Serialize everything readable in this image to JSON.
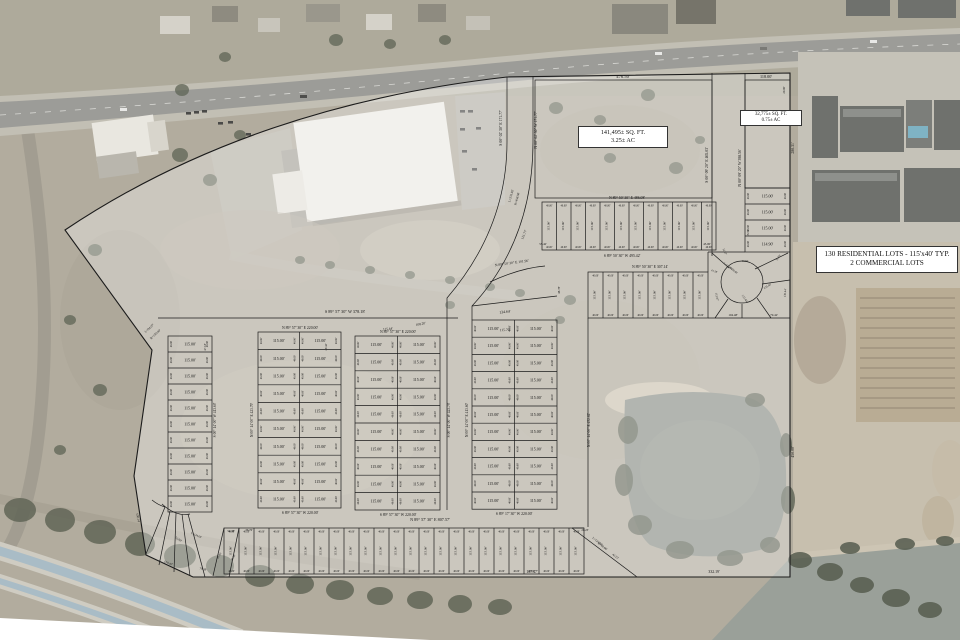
{
  "legend": {
    "line1": "130 RESIDENTIAL LOTS - 115'x40' TYP.",
    "line2": "2 COMMERCIAL LOTS"
  },
  "commercial_lots": [
    {
      "sqft": "141,495± SQ. FT.",
      "acres": "3.25± AC"
    },
    {
      "sqft": "32,775± SQ. FT.",
      "acres": "0.75± AC"
    }
  ],
  "lot": {
    "w": "115.00'",
    "d": "40.00'"
  },
  "colors": {
    "plat_line": "#1b1b1b",
    "plat_text": "#141414",
    "plat_wash": "rgba(255,255,255,0.33)",
    "label_box_bg": "#ffffff",
    "ground": "#b2ac9e",
    "asphalt": "#9c9c98",
    "pond": "#8c918a",
    "canal_water": "#a9bcc6",
    "vegetation": "#5d6253"
  },
  "plat": {
    "boundary": "M65,230 Q250,106 507,77 L790,73 L790,577 L193,577 L146,555 L134,476 L152,350 Z",
    "paths": [
      "M507,77 L507,142 Q507,228 447,298 L447,510",
      "M533,76 L533,142 Q533,240 472,306 L472,320",
      "M472,306 L557,296",
      "M490,282 Q520,268 545,266",
      "M158,318 L458,318",
      "M712,73 L712,256",
      "M745,73 L745,188",
      "M708,252 L745,252",
      "M708,252 L708,272",
      "M708,318 L790,318",
      "M742,304 L742,318",
      "M728,299 L715,318",
      "M757,298 L771,318",
      "M762,284 L790,280",
      "M755,269 L788,253",
      "M729,268 L712,253",
      "M588,318 L588,527",
      "M572,528 L637,577",
      "M584,528 L572,528",
      "M224,528 L213,576",
      "M239,528 L229,577",
      "M165,507 L146,554",
      "M170,511 L159,565",
      "M176,513 L174,572",
      "M182,514 L190,576",
      "M188,514 L205,577",
      "M162,504 Q176,517 190,514",
      "M152,500 Q158,505 165,507"
    ],
    "rects": [
      {
        "x": 535,
        "y": 80,
        "w": 177,
        "h": 118
      },
      {
        "x": 745,
        "y": 80,
        "w": 45,
        "h": 108
      }
    ],
    "circles": [
      {
        "cx": 742,
        "cy": 282,
        "r": 21
      }
    ],
    "blocks": [
      {
        "kind": "h",
        "x": 168,
        "y": 336,
        "w": 44,
        "rowH": 16,
        "rows": 11,
        "cols": 1
      },
      {
        "kind": "h",
        "x": 258,
        "y": 332,
        "w": 41.5,
        "rowH": 17.6,
        "rows": 10,
        "cols": 2
      },
      {
        "kind": "h",
        "x": 355,
        "y": 336,
        "w": 42.5,
        "rowH": 17.4,
        "rows": 10,
        "cols": 2
      },
      {
        "kind": "h",
        "x": 472,
        "y": 320,
        "w": 42.5,
        "rowH": 17.2,
        "rows": 11,
        "cols": 2
      },
      {
        "kind": "h",
        "x": 745,
        "y": 188,
        "w": 45,
        "rowH": 16,
        "rows": 4,
        "cols": 1,
        "rowLabels": [
          "115.00'",
          "115.00'",
          "115.00'",
          "114.90'"
        ]
      },
      {
        "kind": "v",
        "x": 542,
        "y": 202,
        "cw": 14.5,
        "h": 48,
        "n": 12
      },
      {
        "kind": "v",
        "x": 588,
        "y": 272,
        "cw": 15,
        "h": 46,
        "n": 8
      },
      {
        "kind": "v",
        "x": 224,
        "y": 528,
        "cw": 15,
        "h": 46,
        "n": 24
      }
    ],
    "labels": [
      {
        "t": "476.50'",
        "x": 623,
        "y": 78,
        "s": 4.6
      },
      {
        "t": "118.00'",
        "x": 766,
        "y": 78,
        "s": 4.2
      },
      {
        "t": "S 00° 02' 30\" E 171.77'",
        "x": 502,
        "y": 128,
        "r": -90,
        "s": 3.8
      },
      {
        "t": "N 00° 02' 30\" W 171.77'",
        "x": 537,
        "y": 130,
        "r": -90,
        "s": 3.8
      },
      {
        "t": "S 00° 09' 20\" E 465.03'",
        "x": 708,
        "y": 165,
        "r": -90,
        "s": 3.8
      },
      {
        "t": "N 00° 09' 20\" W 398.56'",
        "x": 741,
        "y": 168,
        "r": -90,
        "s": 3.8
      },
      {
        "t": "280.31'",
        "x": 794,
        "y": 148,
        "r": -90,
        "s": 3.8
      },
      {
        "t": "20.00'",
        "x": 785,
        "y": 90,
        "r": -90,
        "s": 3
      },
      {
        "t": "L=231.82'",
        "x": 512,
        "y": 196,
        "r": -75,
        "s": 3.2
      },
      {
        "t": "R=458.50'",
        "x": 518,
        "y": 199,
        "r": -75,
        "s": 3.2
      },
      {
        "t": "121.77'",
        "x": 525,
        "y": 235,
        "r": -68,
        "s": 3.4
      },
      {
        "t": "N 89° 50' 30\" E 486.08'",
        "x": 627,
        "y": 199,
        "s": 3.8
      },
      {
        "t": "55.42'",
        "x": 543,
        "y": 245,
        "s": 3.1
      },
      {
        "t": "45.00'",
        "x": 707,
        "y": 245,
        "s": 3.1
      },
      {
        "t": "S 89° 50' 30\" W 495.42'",
        "x": 622,
        "y": 257,
        "s": 3.8
      },
      {
        "t": "N 89° 50' 30\" E 307.14'",
        "x": 650,
        "y": 268,
        "s": 3.8
      },
      {
        "t": "N 89° 50' 30\" E 101.96'",
        "x": 512,
        "y": 264,
        "r": -8,
        "s": 3.6
      },
      {
        "t": "48.78'",
        "x": 560,
        "y": 290,
        "r": -90,
        "s": 3.1
      },
      {
        "t": "134.64'",
        "x": 505,
        "y": 313,
        "r": -6,
        "s": 3.8
      },
      {
        "t": "115.70'",
        "x": 505,
        "y": 331,
        "r": -3,
        "s": 3.6
      },
      {
        "t": "115.44'",
        "x": 388,
        "y": 330,
        "r": -5,
        "s": 3.4
      },
      {
        "t": "108.20'",
        "x": 421,
        "y": 325,
        "r": -12,
        "s": 3.4
      },
      {
        "t": "L=94.07'",
        "x": 150,
        "y": 329,
        "r": -42,
        "s": 3.2
      },
      {
        "t": "R=150.00'",
        "x": 156,
        "y": 335,
        "r": -42,
        "s": 3.2
      },
      {
        "t": "S 89° 57' 30\" W 378.18'",
        "x": 345,
        "y": 313,
        "s": 4.2
      },
      {
        "t": "N 89° 57' 30\" E 220.00'",
        "x": 300,
        "y": 329,
        "s": 3.8
      },
      {
        "t": "N 89° 57' 30\" E 220.00'",
        "x": 398,
        "y": 333,
        "s": 3.8
      },
      {
        "t": "47.18'",
        "x": 206,
        "y": 347,
        "r": -90,
        "s": 3
      },
      {
        "t": "49.43'",
        "x": 327,
        "y": 347,
        "r": -90,
        "s": 3
      },
      {
        "t": "S 00° 14' 00\" W 413.60'",
        "x": 216,
        "y": 420,
        "r": -90,
        "s": 3.6
      },
      {
        "t": "N 00° 14' 00\" E 423.79'",
        "x": 253,
        "y": 420,
        "r": -90,
        "s": 3.6
      },
      {
        "t": "S 00° 14' 00\" W 423.79'",
        "x": 450,
        "y": 420,
        "r": -90,
        "s": 3.6
      },
      {
        "t": "N 00° 14' 00\" E 413.60'",
        "x": 468,
        "y": 420,
        "r": -90,
        "s": 3.6
      },
      {
        "t": "S 89° 57' 30\" W 220.00'",
        "x": 300,
        "y": 514,
        "s": 3.8
      },
      {
        "t": "S 89° 57' 30\" W 220.00'",
        "x": 398,
        "y": 516,
        "s": 3.8
      },
      {
        "t": "S 89° 17' 30\" W 220.00'",
        "x": 514,
        "y": 515,
        "s": 3.8
      },
      {
        "t": "N 89° 57' 30\" E 807.57'",
        "x": 430,
        "y": 521,
        "s": 4.2
      },
      {
        "t": "N 00° 14' 00\" E 452.62'",
        "x": 590,
        "y": 430,
        "r": -90,
        "s": 3.6
      },
      {
        "t": "450.00'",
        "x": 794,
        "y": 452,
        "r": -90,
        "s": 3.8
      },
      {
        "t": "18.35'",
        "x": 749,
        "y": 233,
        "r": -90,
        "s": 2.8
      },
      {
        "t": "12.57'",
        "x": 724,
        "y": 252,
        "r": 65,
        "s": 2.8
      },
      {
        "t": "70.23'",
        "x": 779,
        "y": 258,
        "r": -60,
        "s": 2.8
      },
      {
        "t": "L=124.82'",
        "x": 728,
        "y": 267,
        "r": 38,
        "s": 2.7
      },
      {
        "t": "R=50.00'",
        "x": 733,
        "y": 271,
        "r": 38,
        "s": 2.7
      },
      {
        "t": "47.55'",
        "x": 745,
        "y": 262,
        "s": 2.7
      },
      {
        "t": "41.28'",
        "x": 714,
        "y": 272,
        "r": 20,
        "s": 2.7
      },
      {
        "t": "135.40'",
        "x": 768,
        "y": 287,
        "r": -32,
        "s": 2.9
      },
      {
        "t": "133.44'",
        "x": 744,
        "y": 299,
        "r": 55,
        "s": 2.9
      },
      {
        "t": "112.97'",
        "x": 716,
        "y": 297,
        "r": 80,
        "s": 2.9
      },
      {
        "t": "130.44'",
        "x": 786,
        "y": 293,
        "r": -86,
        "s": 2.9
      },
      {
        "t": "104.48'",
        "x": 733,
        "y": 316,
        "s": 3.2
      },
      {
        "t": "79.42'",
        "x": 774,
        "y": 316,
        "s": 3.2
      },
      {
        "t": "167.47'",
        "x": 532,
        "y": 573,
        "s": 3.8
      },
      {
        "t": "332.19'",
        "x": 714,
        "y": 573,
        "s": 3.8
      },
      {
        "t": "L=124.06'",
        "x": 597,
        "y": 542,
        "r": 38,
        "s": 3
      },
      {
        "t": "R=60.00'",
        "x": 602,
        "y": 547,
        "r": 38,
        "s": 3
      },
      {
        "t": "42.23'",
        "x": 615,
        "y": 557,
        "r": 38,
        "s": 3
      },
      {
        "t": "20.23'",
        "x": 585,
        "y": 531,
        "s": 3
      },
      {
        "t": "54.38'",
        "x": 231,
        "y": 532,
        "s": 3
      },
      {
        "t": "36.76'",
        "x": 249,
        "y": 531,
        "s": 3
      },
      {
        "t": "100.47'",
        "x": 168,
        "y": 564,
        "r": 22,
        "s": 3.2
      },
      {
        "t": "100.14'",
        "x": 137,
        "y": 518,
        "r": 78,
        "s": 3.2
      },
      {
        "t": "79.39'",
        "x": 203,
        "y": 570,
        "r": 12,
        "s": 3
      },
      {
        "t": "52.00'",
        "x": 178,
        "y": 540,
        "r": 33,
        "s": 3
      },
      {
        "t": "L=124.69'",
        "x": 196,
        "y": 536,
        "r": 24,
        "s": 2.8
      },
      {
        "t": "41.93'",
        "x": 220,
        "y": 556,
        "r": -62,
        "s": 2.8
      },
      {
        "t": "40.00'",
        "x": 234,
        "y": 558,
        "r": -62,
        "s": 2.8
      }
    ]
  }
}
